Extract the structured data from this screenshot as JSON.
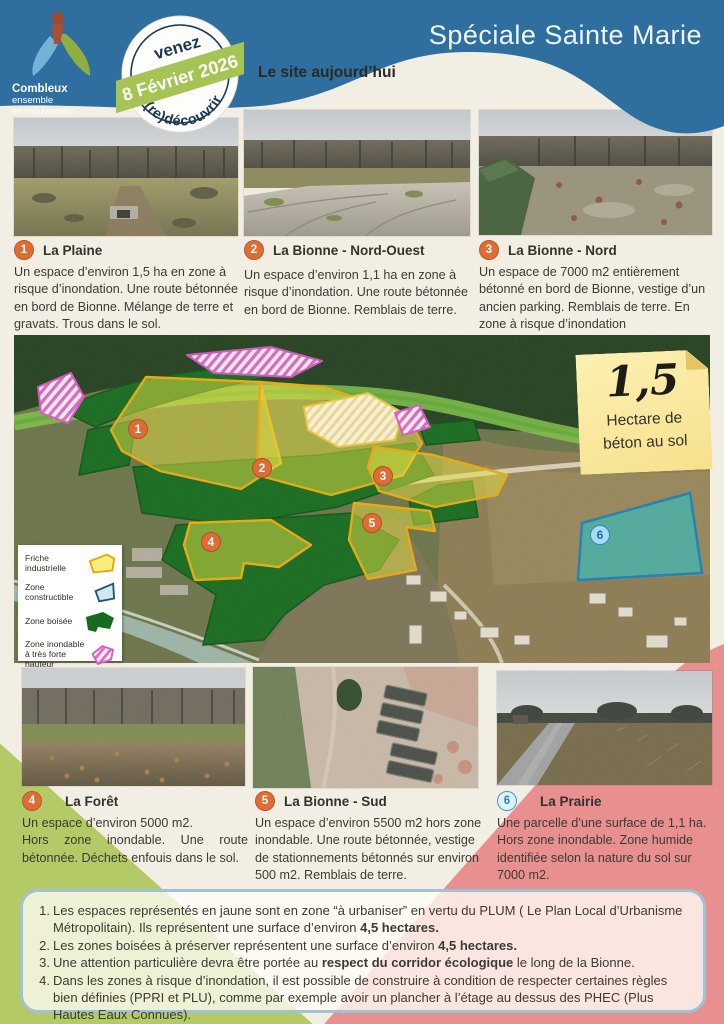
{
  "colors": {
    "header_blue": "#2e6f9f",
    "cream": "#f3eee3",
    "accent_green": "#b4ca66",
    "accent_pink": "#e8908f",
    "orange_marker": "#dd6d35",
    "zone_yellow_border": "#eaa90e",
    "zone_green": "#176b1e",
    "zone_teal": "#3fb3ab",
    "zone_pink": "#e468c8"
  },
  "header": {
    "title": "Spéciale Sainte Marie",
    "section_title": "Le site aujourd’hui",
    "logo": {
      "line1": "Combleux",
      "line2": "ensemble",
      "line3": "en mouvement"
    },
    "stamp": {
      "top": "venez",
      "banner": "8 Février 2026",
      "bottom": "(re)découvrir"
    }
  },
  "sites_top": [
    {
      "num": "1",
      "name": "La Plaine",
      "desc": "Un espace d’environ 1,5 ha en zone à risque d’inondation. Une route bétonnée en bord de Bionne. Mélange de terre et gravats. Trous dans le sol."
    },
    {
      "num": "2",
      "name": "La Bionne - Nord-Ouest",
      "desc": "Un espace d’environ 1,1 ha en zone à risque d’inondation. Une route bétonnée en bord de Bionne. Remblais de terre."
    },
    {
      "num": "3",
      "name": "La Bionne - Nord",
      "desc": "Un espace de 7000 m2 entièrement bétonné en bord de Bionne, vestige d’un ancien parking. Remblais de terre. En zone à risque d’inondation"
    }
  ],
  "sites_bottom": [
    {
      "num": "4",
      "name": "La Forêt",
      "desc": "Un espace d’environ 5000 m2.\nHors zone inondable. Une route bétonnée. Déchets enfouis dans le sol."
    },
    {
      "num": "5",
      "name": "La Bionne - Sud",
      "desc": "Un espace d’environ 5500 m2 hors zone inondable. Une route bétonnée, vestige de stationnements bétonnés sur environ 500 m2. Remblais de terre."
    },
    {
      "num": "6",
      "name": "La Prairie",
      "desc": "Une parcelle d’une surface de 1,1 ha. Hors zone inondable. Zone humide identifiée selon la nature du sol sur 7000 m2."
    }
  ],
  "map": {
    "legend": [
      {
        "label": "Friche industrielle",
        "type": "yellow"
      },
      {
        "label": "Zone constructible",
        "type": "blue"
      },
      {
        "label": "Zone boisée",
        "type": "green"
      },
      {
        "label": "Zone inondable\nà très forte hauteur",
        "type": "pink"
      }
    ],
    "markers": [
      {
        "num": "1"
      },
      {
        "num": "2"
      },
      {
        "num": "3"
      },
      {
        "num": "4"
      },
      {
        "num": "5"
      },
      {
        "num": "6"
      }
    ],
    "sticky_note": {
      "big": "1,5",
      "line1": "Hectare de",
      "line2": "béton au sol"
    }
  },
  "notes": [
    {
      "num": "1.",
      "segments": [
        {
          "t": "Les espaces représentés en jaune sont en zone “à urbaniser” en vertu du PLUM ( Le Plan Local d’Urbanisme Métropolitain). Ils représentent une surface d’environ "
        },
        {
          "t": "4,5 hectares.",
          "b": true
        }
      ]
    },
    {
      "num": "2.",
      "segments": [
        {
          "t": "Les zones boisées à préserver représentent une surface d’environ "
        },
        {
          "t": "4,5 hectares.",
          "b": true
        }
      ]
    },
    {
      "num": "3.",
      "segments": [
        {
          "t": "Une attention particulière devra être portée au "
        },
        {
          "t": "respect du corridor écologique",
          "b": true
        },
        {
          "t": " le long de la Bionne."
        }
      ]
    },
    {
      "num": "4.",
      "segments": [
        {
          "t": "Dans les zones à risque d’inondation, il est possible de construire à condition de respecter certaines règles bien définies (PPRI et PLU), comme par exemple avoir un plancher à l’étage au dessus des PHEC (Plus Hautes Eaux Connues)."
        }
      ]
    }
  ]
}
